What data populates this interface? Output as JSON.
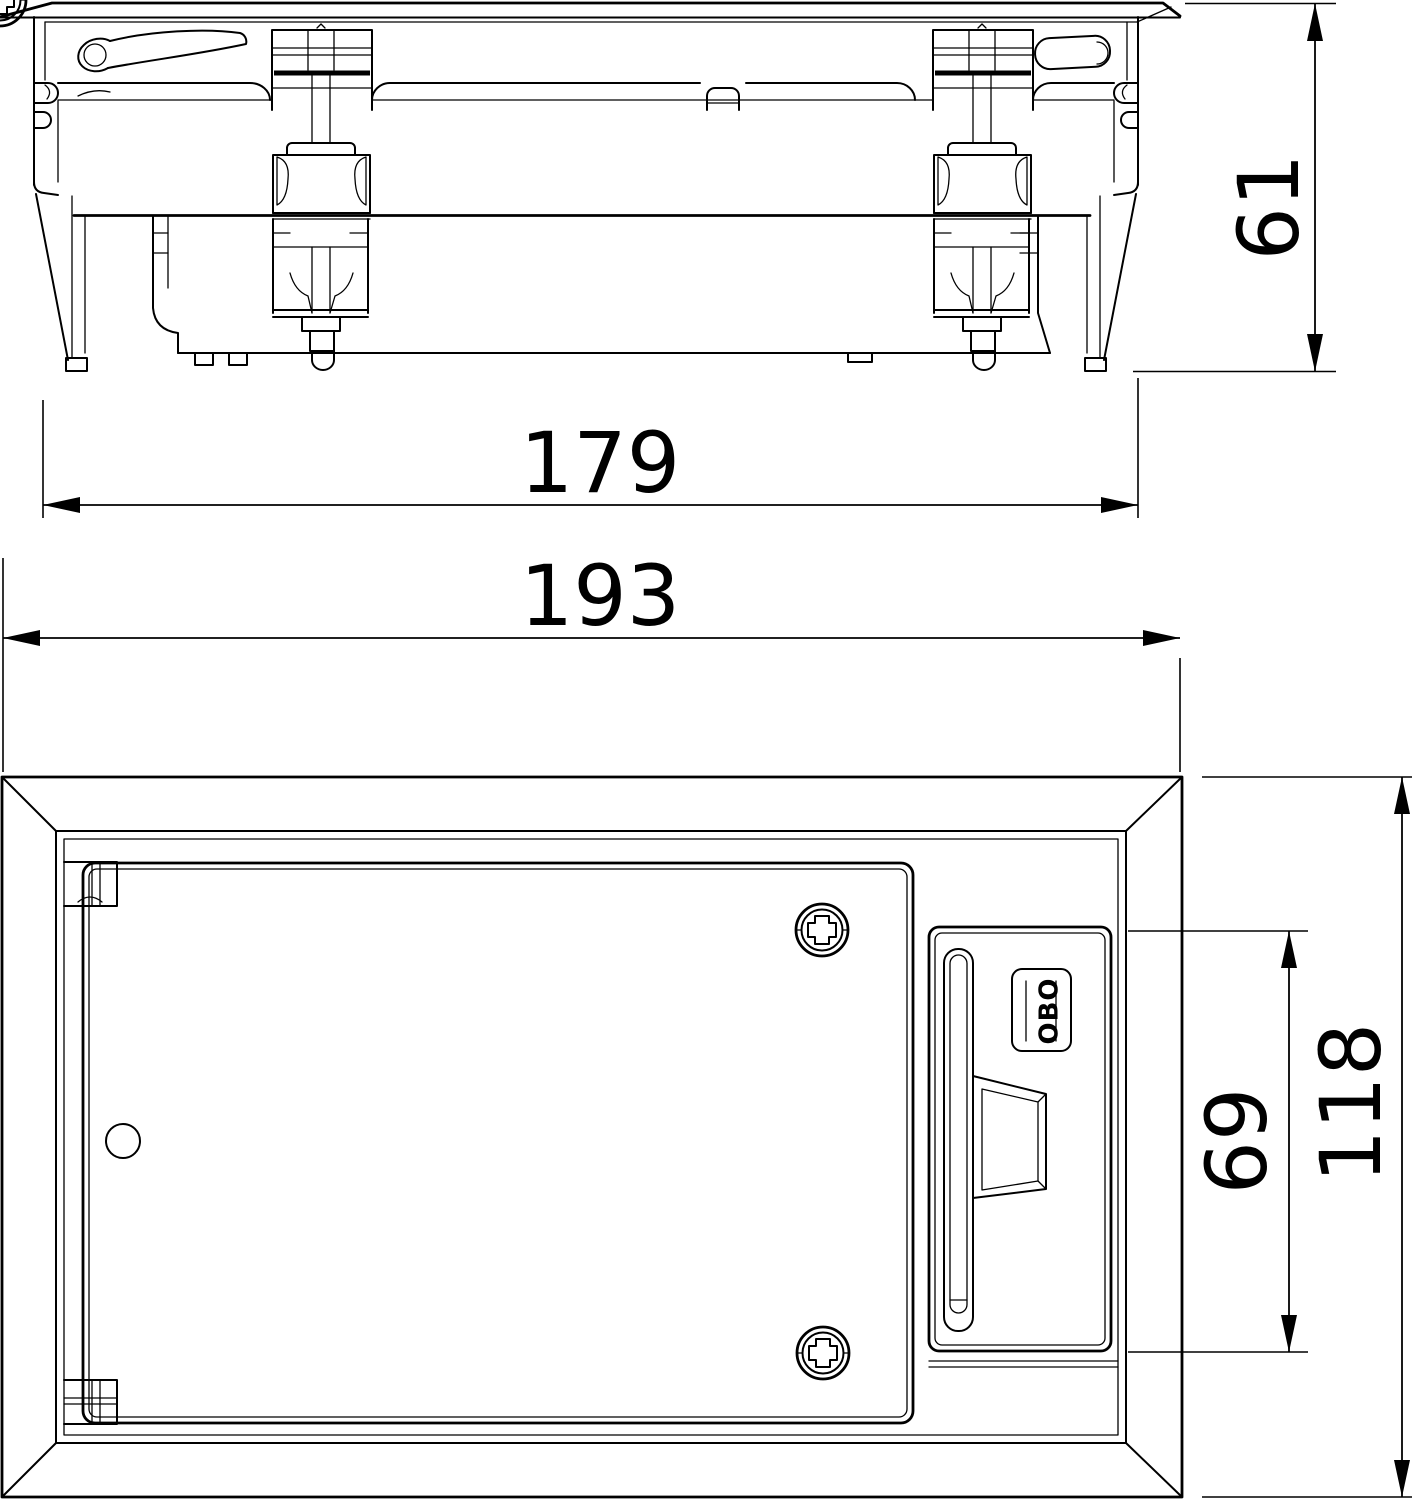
{
  "drawing": {
    "dimensions": {
      "side_height_mm": "61",
      "body_width_mm": "179",
      "overall_width_mm": "193",
      "latch_module_height_mm": "69",
      "overall_depth_mm": "118"
    },
    "logo_text": "OBO",
    "colors": {
      "line": "#000000",
      "background": "#ffffff"
    }
  }
}
